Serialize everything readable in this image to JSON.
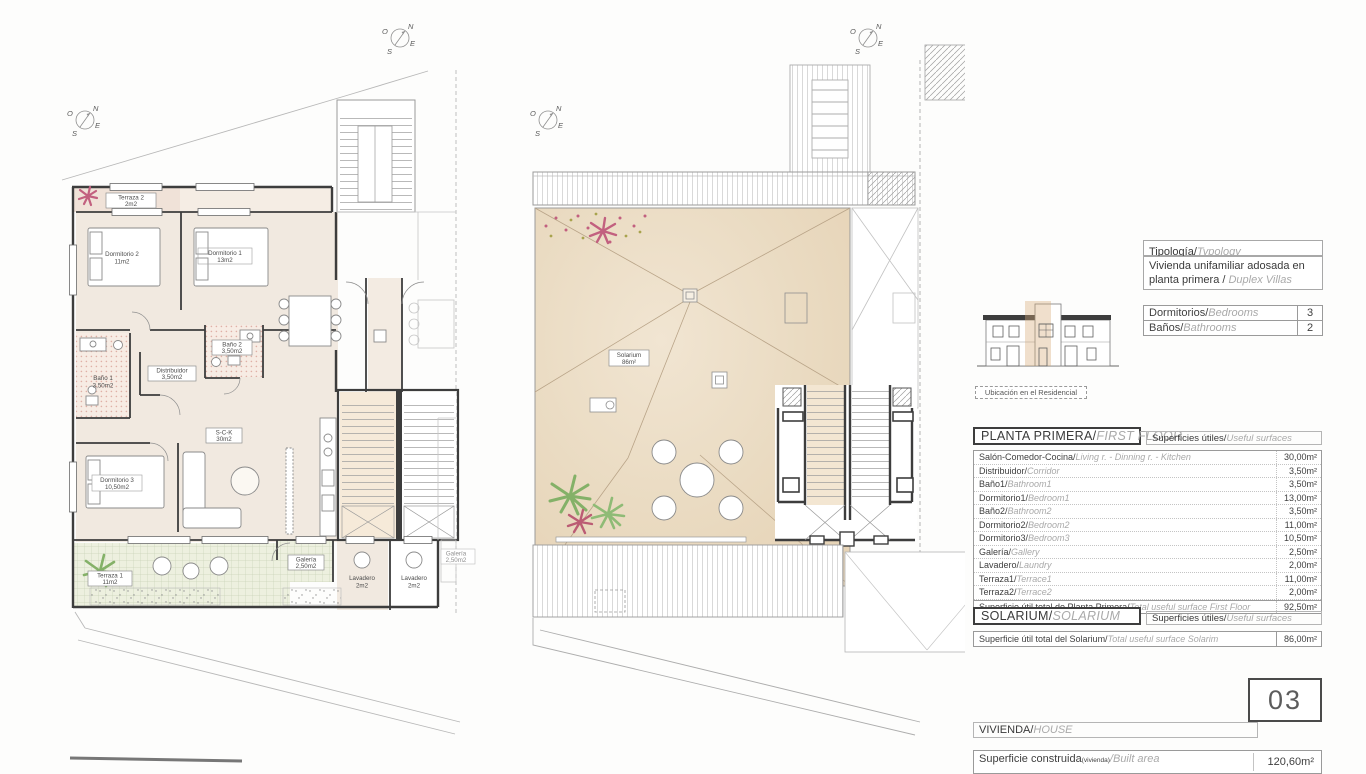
{
  "compass": {
    "n": "N",
    "s": "S",
    "e": "E",
    "o": "O"
  },
  "plans": {
    "first_floor": {
      "labels": {
        "terraza2": {
          "name": "Terraza 2",
          "area": "2m2"
        },
        "dormitorio2": {
          "name": "Dormitorio 2",
          "area": "11m2"
        },
        "dormitorio1": {
          "name": "Dormitorio 1",
          "area": "13m2"
        },
        "bano1": {
          "name": "Baño 1",
          "area": "3,50m2"
        },
        "bano2": {
          "name": "Baño 2",
          "area": "3,50m2"
        },
        "distribuidor": {
          "name": "Distribuidor",
          "area": "3,50m2"
        },
        "sck": {
          "name": "S-C-K",
          "area": "30m2"
        },
        "dormitorio3": {
          "name": "Dormitorio 3",
          "area": "10,50m2"
        },
        "terraza1": {
          "name": "Terraza 1",
          "area": "11m2"
        },
        "galeria": {
          "name": "Galería",
          "area": "2,50m2"
        },
        "lavadero_a": {
          "name": "Lavadero",
          "area": "2m2"
        },
        "lavadero_b": {
          "name": "Lavadero",
          "area": "2m2"
        },
        "galeria_b": {
          "name": "Galería",
          "area": "2,50m2"
        }
      }
    },
    "solarium": {
      "labels": {
        "solarium": {
          "name": "Solarium",
          "area": "86m²"
        }
      }
    }
  },
  "panel": {
    "typology": {
      "label_es": "Tipología/",
      "label_en": "Typology",
      "value_line1": "Vivienda unifamiliar adosada en",
      "value_line2_es": "planta primera / ",
      "value_line2_en": "Duplex Villas"
    },
    "counts": [
      {
        "es": "Dormitorios/",
        "en": "Bedrooms",
        "value": "3"
      },
      {
        "es": "Baños/",
        "en": "Bathrooms",
        "value": "2"
      }
    ],
    "location_caption": "Ubicación en el Residencial",
    "first_floor": {
      "header_es": "PLANTA PRIMERA/",
      "header_en": "FIRST FLOOR",
      "surfaces_es": "Superficies útiles/",
      "surfaces_en": "Useful surfaces",
      "rows": [
        {
          "es": "Salón-Comedor-Cocina/",
          "en": "Living r. - Dinning r. - Kitchen",
          "value": "30,00m²"
        },
        {
          "es": "Distribuidor/",
          "en": "Corridor",
          "value": "3,50m²"
        },
        {
          "es": "Baño1/",
          "en": "Bathroom1",
          "value": "3,50m²"
        },
        {
          "es": "Dormitorio1/",
          "en": "Bedroom1",
          "value": "13,00m²"
        },
        {
          "es": "Baño2/",
          "en": "Bathroom2",
          "value": "3,50m²"
        },
        {
          "es": "Dormitorio2/",
          "en": "Bedroom2",
          "value": "11,00m²"
        },
        {
          "es": "Dormitorio3/",
          "en": "Bedroom3",
          "value": "10,50m²"
        },
        {
          "es": "Galería/",
          "en": "Gallery",
          "value": "2,50m²"
        },
        {
          "es": "Lavadero/",
          "en": "Laundry",
          "value": "2,00m²"
        },
        {
          "es": "Terraza1/",
          "en": "Terrace1",
          "value": "11,00m²"
        },
        {
          "es": "Terraza2/",
          "en": "Terrace2",
          "value": "2,00m²"
        }
      ],
      "total": {
        "es": "Superficie útil total de Planta Primera/",
        "en": "Total useful surface First Floor",
        "value": "92,50m²"
      }
    },
    "solarium": {
      "header_es": "SOLARIUM/",
      "header_en": "SOLARIUM",
      "surfaces_es": "Superficies útiles/",
      "surfaces_en": "Useful surfaces",
      "total": {
        "es": "Superficie útil total del Solarium/",
        "en": "Total useful surface Solarim",
        "value": "86,00m²"
      }
    },
    "unit_number": "03",
    "house": {
      "header_es": "VIVIENDA/",
      "header_en": "HOUSE",
      "built_es": "Superficie construida",
      "built_sub": "(vivienda)",
      "built_en": "/Built area",
      "built_value": "120,60m²"
    }
  }
}
